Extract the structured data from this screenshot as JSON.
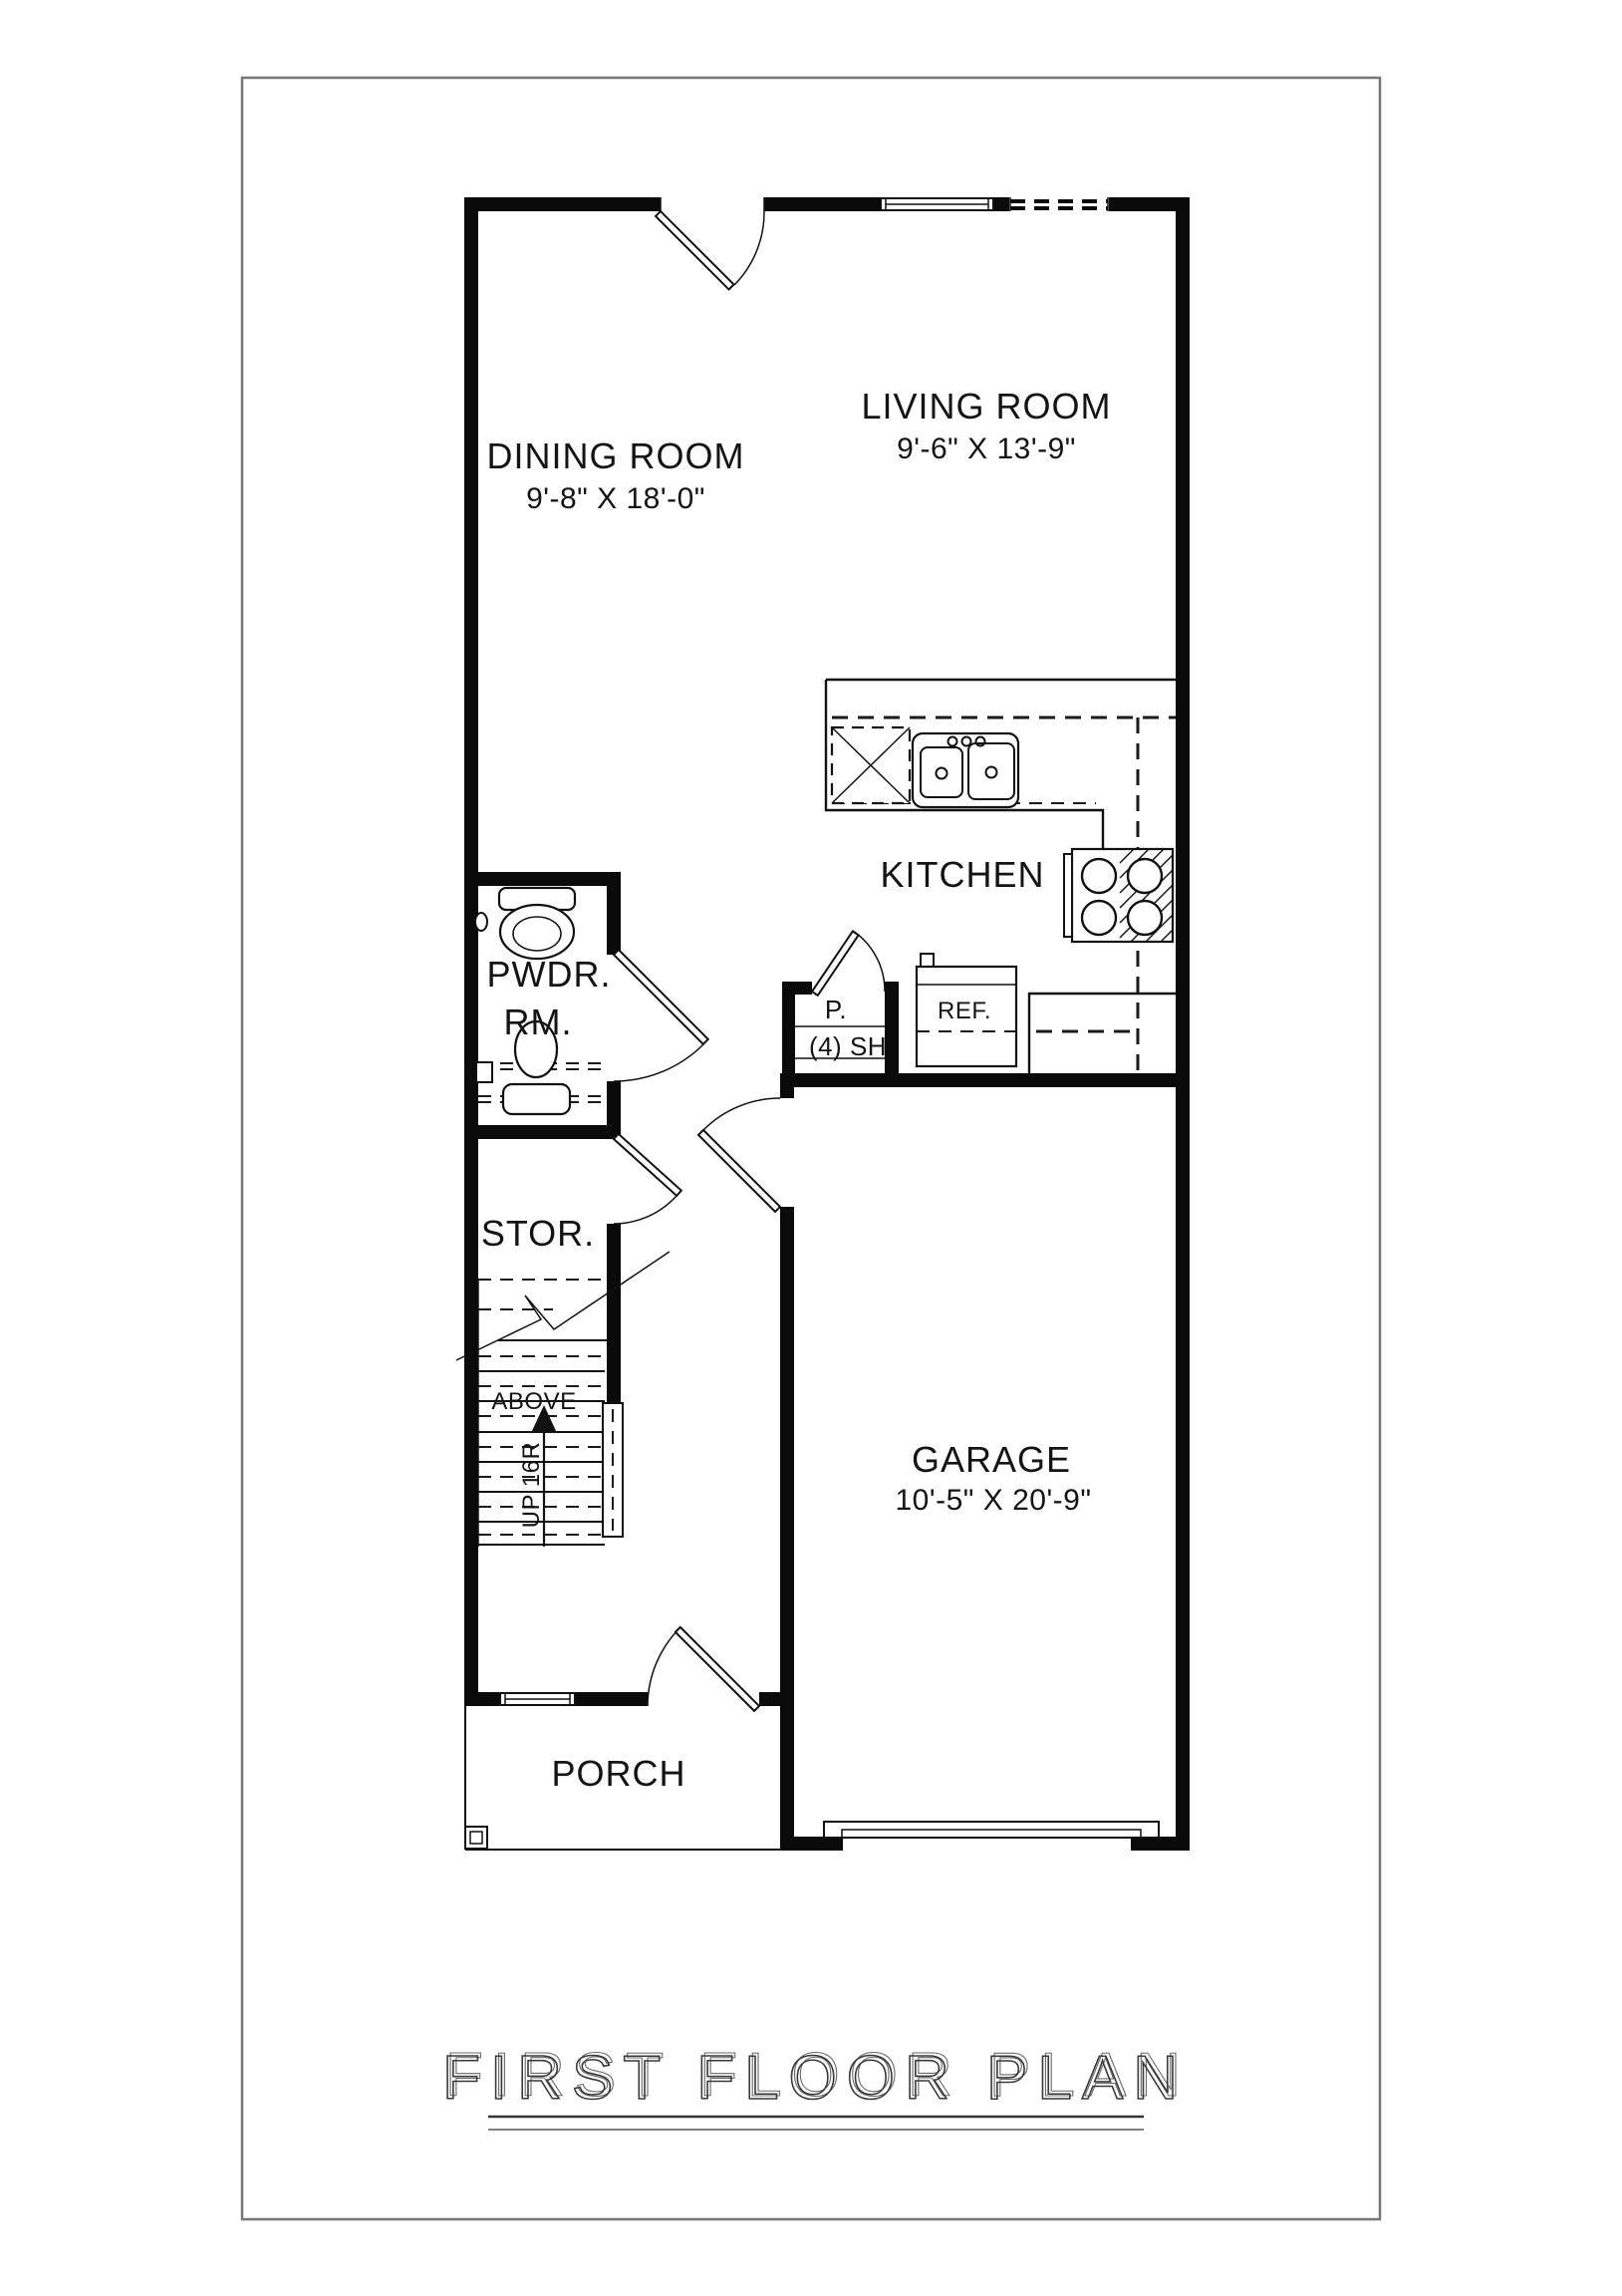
{
  "title": "FIRST FLOOR PLAN",
  "rooms": {
    "dining": {
      "label": "DINING ROOM",
      "dims": "9'-8\" X 18'-0\""
    },
    "living": {
      "label": "LIVING ROOM",
      "dims": "9'-6\" X 13'-9\""
    },
    "kitchen": {
      "label": "KITCHEN"
    },
    "powder": {
      "label_line1": "PWDR.",
      "label_line2": "RM."
    },
    "storage": {
      "label": "STOR."
    },
    "garage": {
      "label": "GARAGE",
      "dims": "10'-5\" X 20'-9\""
    },
    "porch": {
      "label": "PORCH"
    }
  },
  "fixtures": {
    "refrigerator": "REF.",
    "pantry": "P.",
    "pantry_shelves": "(4) SH"
  },
  "stairs": {
    "above_label": "ABOVE",
    "direction_label": "UP 16R"
  },
  "colors": {
    "wall": "#0a0a0a",
    "line": "#111111",
    "background": "#ffffff",
    "page_border": "#777777",
    "title": "#3a3a3a"
  }
}
